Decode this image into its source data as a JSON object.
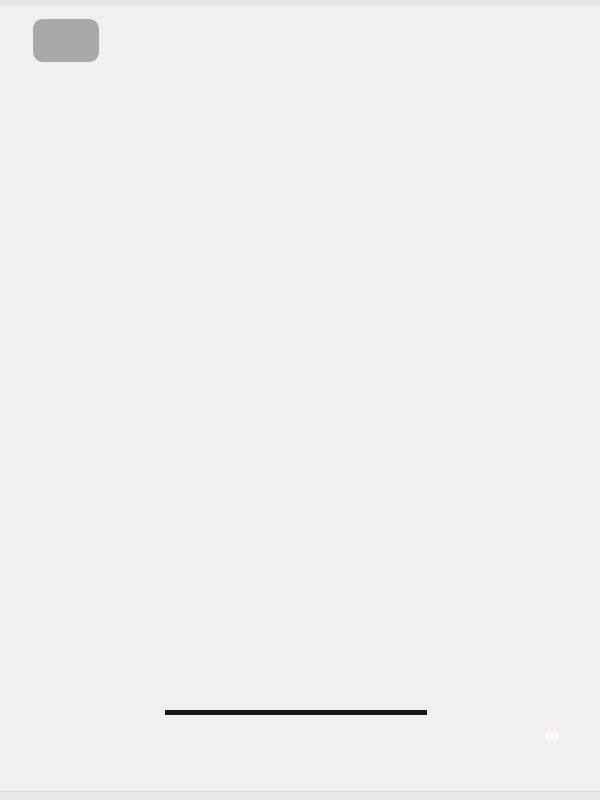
{
  "page": {
    "indicator": "1/1"
  },
  "floor_plan": {
    "rooms": [
      {
        "id": "balcony-top",
        "label": "阳台"
      },
      {
        "id": "kitchen",
        "label": "厨房"
      },
      {
        "id": "entry",
        "label": "玄关"
      },
      {
        "id": "bedroom-top",
        "label": "卧室"
      },
      {
        "id": "bathroom-top",
        "label": "卫生间"
      },
      {
        "id": "dining",
        "label": "餐厅"
      },
      {
        "id": "bedroom-middle",
        "label": "卧室"
      },
      {
        "id": "living",
        "label": "客厅"
      },
      {
        "id": "bedroom-bottom",
        "label": "卧室"
      },
      {
        "id": "bathroom-bottom",
        "label": "卫生间"
      },
      {
        "id": "balcony-bottom",
        "label": "阳台"
      }
    ],
    "dimensions": {
      "top": {
        "total": "8500",
        "segments": [
          "700",
          "600",
          "1900",
          "800",
          "1000",
          "1900",
          "1600"
        ]
      },
      "left": {
        "total": "11400",
        "segments": [
          "1200",
          "2400",
          "1700",
          "2400",
          "3100",
          "600"
        ]
      },
      "right": {
        "total": "11400",
        "segments": [
          "1500",
          "1900",
          "6200",
          "1800"
        ]
      },
      "bottom": {
        "total": "8500",
        "segments": [
          "3300",
          "1700",
          "3500"
        ]
      }
    }
  },
  "title": {
    "unit_code": "1D",
    "layout_type": "三室二厅二卫",
    "area": "建筑面积约100M²"
  },
  "disclaimer": {
    "line1": "因每栋塔楼公摊面积不同，本户型具体房间尺",
    "line2": "寸将根据最终建筑面积进行调整确定"
  },
  "watermark": {
    "badge": "小红书",
    "site": "fangxiaoyong.cn"
  },
  "colors": {
    "background": "#f1f0ee",
    "wall": "#2d2b29",
    "wood_floor": "#bba080",
    "bedroom_floor": "#d8c7aa",
    "tile_floor": "#dbd9d6",
    "balcony_floor": "#a3a29f",
    "furniture_fill": "#fbfaf8",
    "furniture_stroke": "#8f8c88",
    "rug": "#f5f3f0",
    "shower_tile": "#d2d0cd",
    "label_bg": "#1d1d1d",
    "label_text": "#ffffff",
    "dim_line": "#3f3f3f",
    "dim_text": "#474747",
    "window_stroke": "#55524f",
    "door_arc": "#6b6966"
  }
}
